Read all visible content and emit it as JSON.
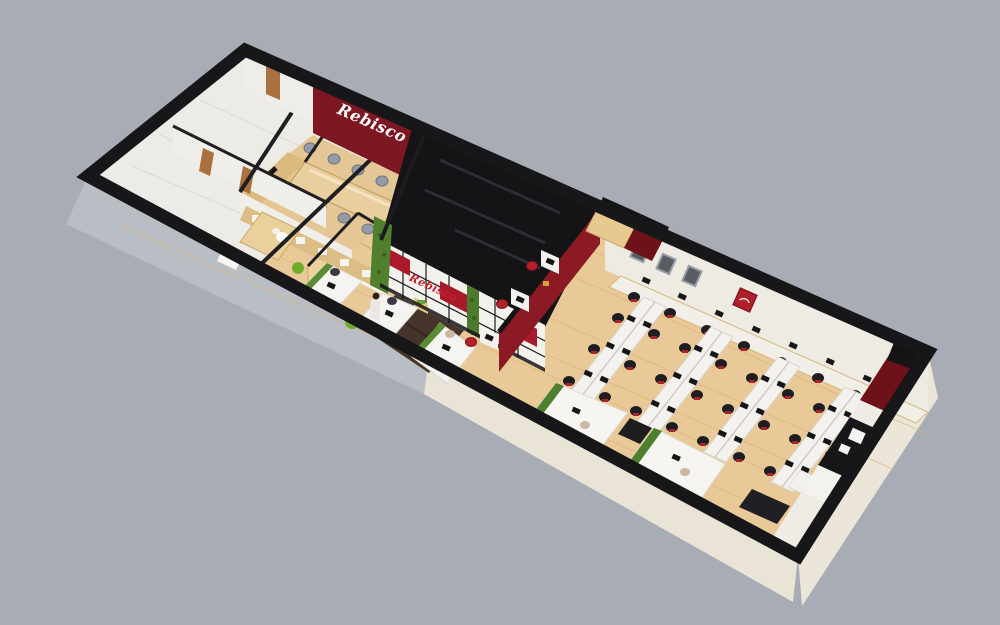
{
  "scene": {
    "description": "3D isometric cutaway render of a long narrow office floor plan, rotated diagonally on a plain gray background",
    "view": "axonometric dollhouse cutaway",
    "background_color": "#a8acb4"
  },
  "brand": {
    "wordmark": "Rebisco",
    "instances": [
      {
        "surface": "conference-room maroon feature wall",
        "style": "white script"
      },
      {
        "surface": "reception display wall",
        "style": "red script on white paneling"
      },
      {
        "surface": "framed red artwork in open office",
        "style": "small white mark"
      }
    ]
  },
  "palette": {
    "background": "#a8acb4",
    "wood_floor": "#e9c997",
    "dark_entry_floor": "#443429",
    "maroon_wall": "#7d1722",
    "accent_red": "#ab1a2b",
    "wall_white": "#f0eee8",
    "black_wall_caps": "#17171a",
    "plant_green": "#4e7e2e",
    "chair_red": "#b3202a",
    "cabinet_wood": "#e0bd83",
    "exterior_gray": "#b9bdc4",
    "exterior_cream": "#eae4d7"
  },
  "rooms": [
    {
      "name": "restroom-service-block"
    },
    {
      "name": "conference-room"
    },
    {
      "name": "pantry-lobby"
    },
    {
      "name": "reception-display-wall"
    },
    {
      "name": "dark-entrance"
    },
    {
      "name": "open-office"
    },
    {
      "name": "kitchenette-corner"
    }
  ],
  "furniture_counts": {
    "conference_chairs": 8,
    "reception_workstations": 3,
    "wall_counter_seats": 7,
    "island_desk_rows": 4,
    "island_seats": 24,
    "private_pods": 2,
    "red_chair_workstations": 3,
    "framed_pictures": 4,
    "plants": 6,
    "people": 1
  }
}
